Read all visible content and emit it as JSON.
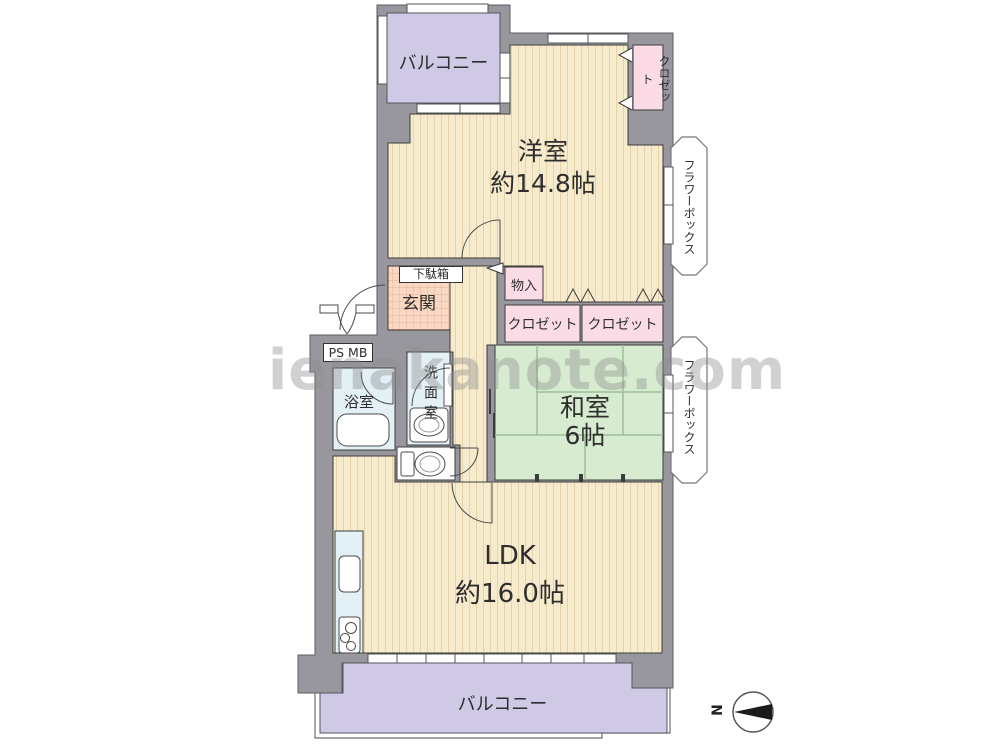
{
  "floorplan": {
    "rooms": {
      "balcony_top": {
        "label": "バルコニー"
      },
      "closet_top": {
        "label": "クロゼット"
      },
      "western_room": {
        "label": "洋室",
        "size": "約14.8帖"
      },
      "flower_box_upper": {
        "label": "フラワーボックス"
      },
      "shoe_cabinet": {
        "label": "下駄箱"
      },
      "entrance": {
        "label": "玄関"
      },
      "storage": {
        "label": "物入"
      },
      "closet_left": {
        "label": "クロゼット"
      },
      "closet_right": {
        "label": "クロゼット"
      },
      "pipe_meter_box": {
        "label": "PS MB"
      },
      "washroom": {
        "label": "洗面室"
      },
      "bathroom": {
        "label": "浴室"
      },
      "japanese_room": {
        "label": "和室",
        "size": "6帖"
      },
      "flower_box_lower": {
        "label": "フラワーボックス"
      },
      "ldk": {
        "label": "LDK",
        "size": "約16.0帖"
      },
      "balcony_bottom": {
        "label": "バルコニー"
      }
    },
    "compass": {
      "label": "N"
    },
    "watermark": {
      "text": "ienakanote.com"
    },
    "colors": {
      "wall": "#98979d",
      "wood_floor": "#f7ebcd",
      "balcony": "#cfc9e6",
      "tatami": "#d7ebd0",
      "closet_pink": "#fbdce6",
      "entrance_tile": "#f8d8c2",
      "wet_area_blue": "#e3f1f7"
    }
  }
}
